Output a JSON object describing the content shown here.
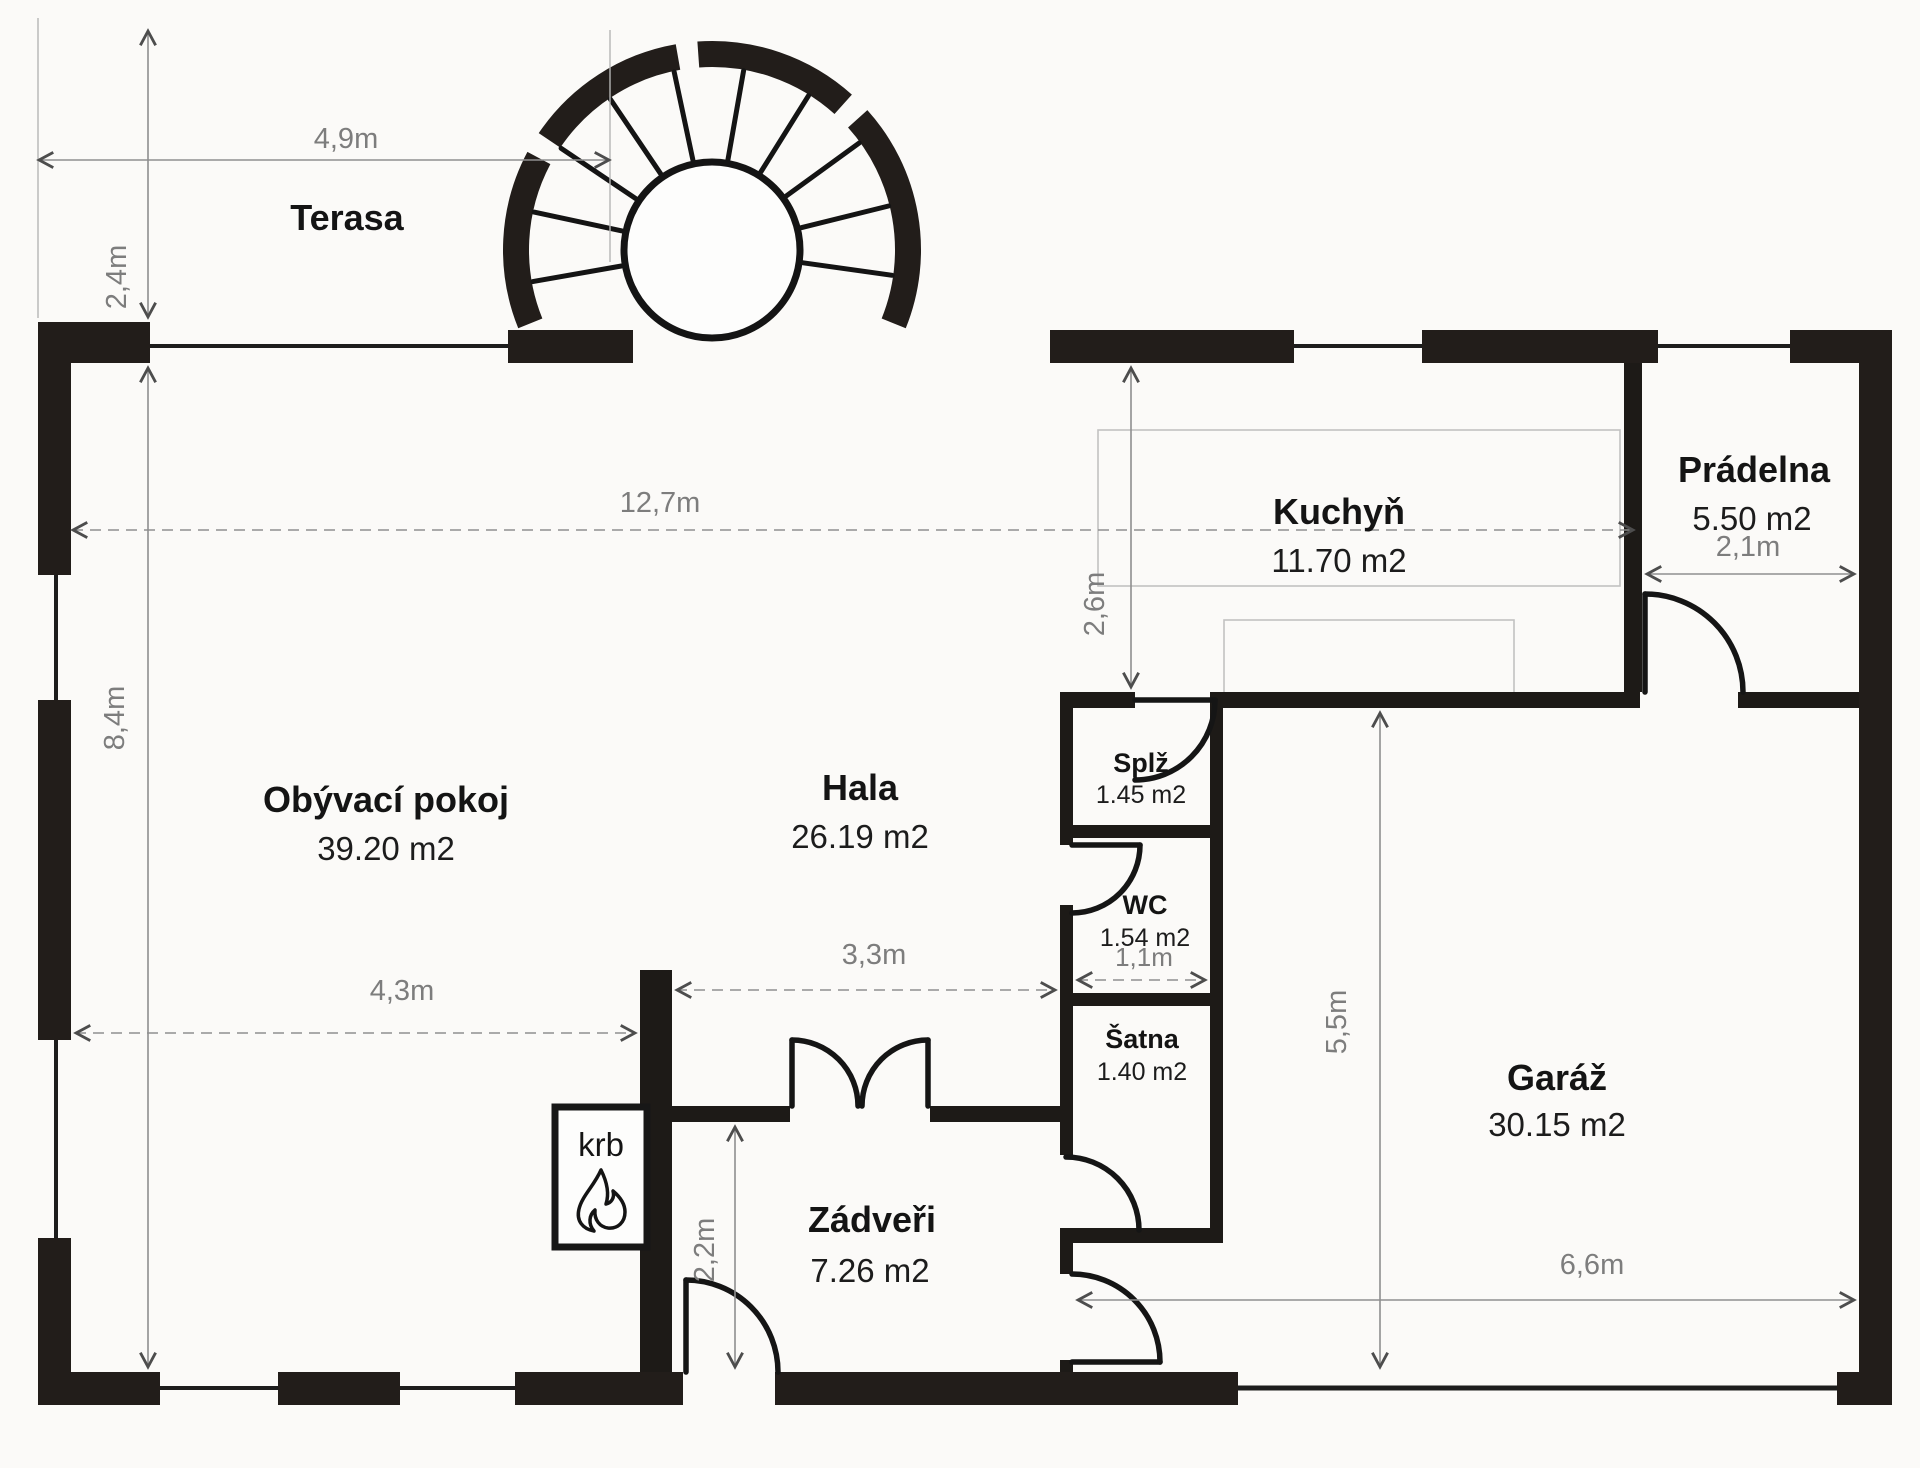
{
  "plan": {
    "type": "floor-plan",
    "language": "cs",
    "wall_color": "#221d1a",
    "dim_color": "#7d7d7d",
    "background": "#fbfaf8"
  },
  "rooms": {
    "terasa": {
      "name": "Terasa"
    },
    "obyvaci": {
      "name": "Obývací pokoj",
      "area": "39.20 m2"
    },
    "hala": {
      "name": "Hala",
      "area": "26.19 m2"
    },
    "kuchyn": {
      "name": "Kuchyň",
      "area": "11.70 m2"
    },
    "pradelna": {
      "name": "Prádelna",
      "area": "5.50 m2"
    },
    "splz": {
      "name": "Splž",
      "area": "1.45 m2"
    },
    "wc": {
      "name": "WC",
      "area": "1.54 m2"
    },
    "satna": {
      "name": "Šatna",
      "area": "1.40 m2"
    },
    "zadveri": {
      "name": "Zádveři",
      "area": "7.26 m2"
    },
    "garaz": {
      "name": "Garáž",
      "area": "30.15 m2"
    },
    "krb": {
      "name": "krb"
    }
  },
  "dimensions": {
    "terrace_width": "4,9m",
    "terrace_depth": "2,4m",
    "main_width": "12,7m",
    "main_height": "8,4m",
    "kitchen_depth": "2,6m",
    "pradelna_width": "2,1m",
    "hala_opening": "3,3m",
    "living_width": "4,3m",
    "wc_width": "1,1m",
    "corridor_height": "5,5m",
    "zadveri_height": "2,2m",
    "garage_width": "6,6m"
  }
}
